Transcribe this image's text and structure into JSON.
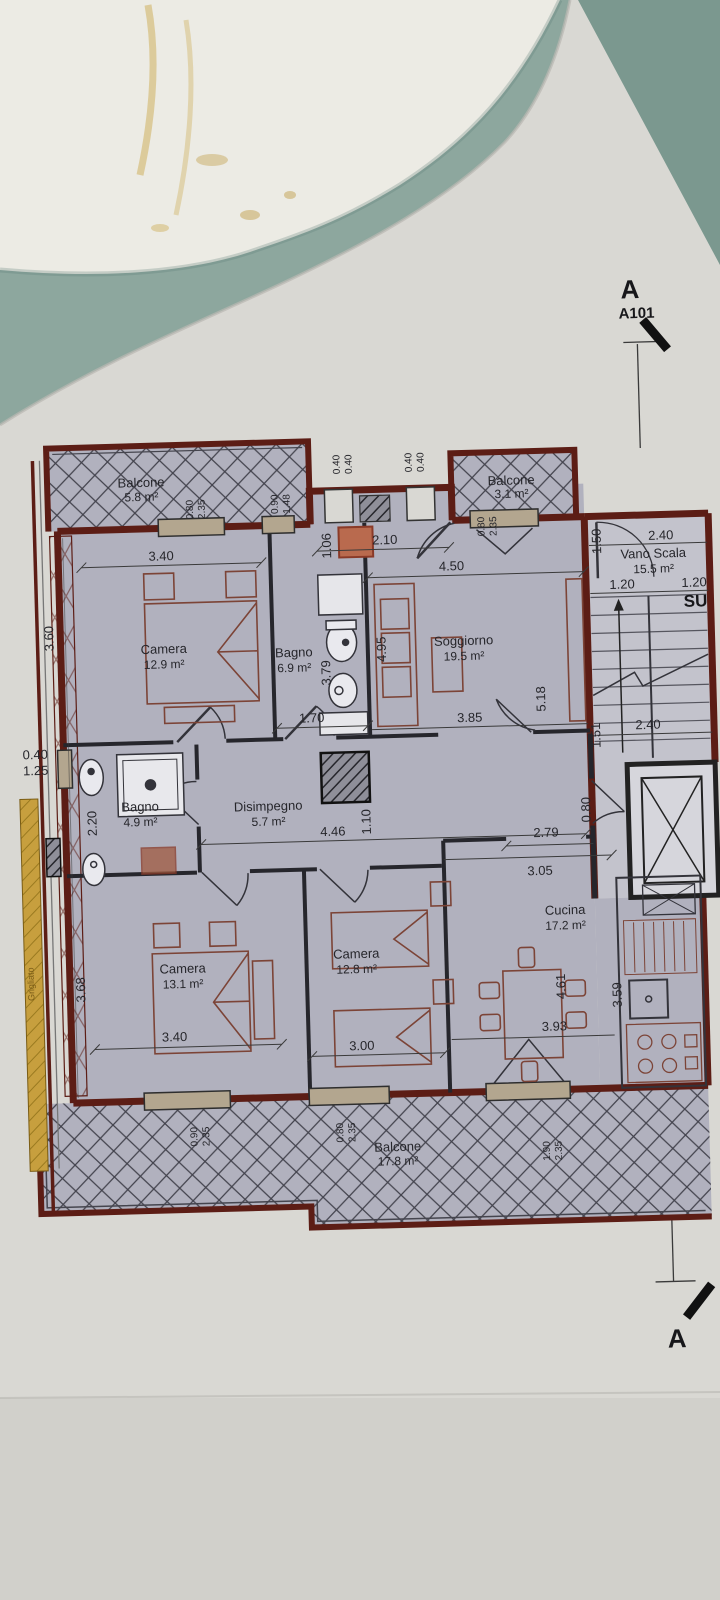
{
  "scene": {
    "background_color": "#8da79e",
    "corner_color": "#7b988f",
    "second_sheet_color": "#ecebe4",
    "paper_color": "#d9d8d3",
    "floor_color": "#b1b1be",
    "wall_color": "#5c1d15"
  },
  "markers": {
    "section_letter_top": "A",
    "section_code": "A101",
    "section_letter_bottom": "A",
    "stairs_up": "SU"
  },
  "rooms": {
    "balcone_tl": {
      "name": "Balcone",
      "area": "5.8 m²"
    },
    "camera1": {
      "name": "Camera",
      "area": "12.9 m²"
    },
    "bagno1": {
      "name": "Bagno",
      "area": "6.9 m²"
    },
    "soggiorno": {
      "name": "Soggiorno",
      "area": "19.5 m²"
    },
    "balcone_tr": {
      "name": "Balcone",
      "area": "3.1 m²"
    },
    "vano_scala": {
      "name": "Vano Scala",
      "area": "15.5 m²"
    },
    "bagno2": {
      "name": "Bagno",
      "area": "4.9 m²"
    },
    "disimpegno": {
      "name": "Disimpegno",
      "area": "5.7 m²"
    },
    "camera2": {
      "name": "Camera",
      "area": "13.1 m²"
    },
    "camera3": {
      "name": "Camera",
      "area": "12.8 m²"
    },
    "cucina": {
      "name": "Cucina",
      "area": "17.2 m²"
    },
    "balcone_b": {
      "name": "Balcone",
      "area": "17.8 m²"
    }
  },
  "dims": {
    "camera1_width": "3.40",
    "camera1_depth": "3.60",
    "entry_width": "2.10",
    "niche_depth": "1.06",
    "soggiorno_width": "4.50",
    "soggiorno_depth": "4.95",
    "bagno1_depth": "3.79",
    "bagno1_width": "1.70",
    "soggiorno_width2": "3.85",
    "soggiorno_depth2": "5.18",
    "scala_top": "1.50",
    "scala_width": "2.40",
    "flight1": "1.20",
    "flight2": "1.20",
    "landing_width": "2.40",
    "landing_depth": "1.51",
    "bagno2_depth": "2.20",
    "corridor_width": "4.46",
    "corridor_depth": "1.10",
    "hall_width": "2.79",
    "hall_passage": "0.80",
    "cucina_top": "3.05",
    "camera2_depth": "3.68",
    "camera2_width": "3.40",
    "camera3_width": "3.00",
    "cucina_width": "3.93",
    "cucina_depth": "3.59",
    "cucina_depth2": "4.61"
  },
  "openings": {
    "b1_window": {
      "w": "0.80",
      "h": "2.35"
    },
    "bagno1_window": {
      "w": "0.90",
      "h": "1.48"
    },
    "pillar_left": {
      "w": "0.40",
      "h": "0.40"
    },
    "pillar_right": {
      "w": "0.40",
      "h": "0.40"
    },
    "b2_door": {
      "w": "0.80",
      "h": "2.35"
    },
    "left_window": {
      "w": "0.40",
      "h": "1.25"
    },
    "cam2_window": {
      "w": "0.90",
      "h": "2.35"
    },
    "cam3_window": {
      "w": "0.80",
      "h": "2.35"
    },
    "cucina_door": {
      "w": "1.90",
      "h": "2.35"
    }
  },
  "labels": {
    "strip": "Grigliato"
  }
}
